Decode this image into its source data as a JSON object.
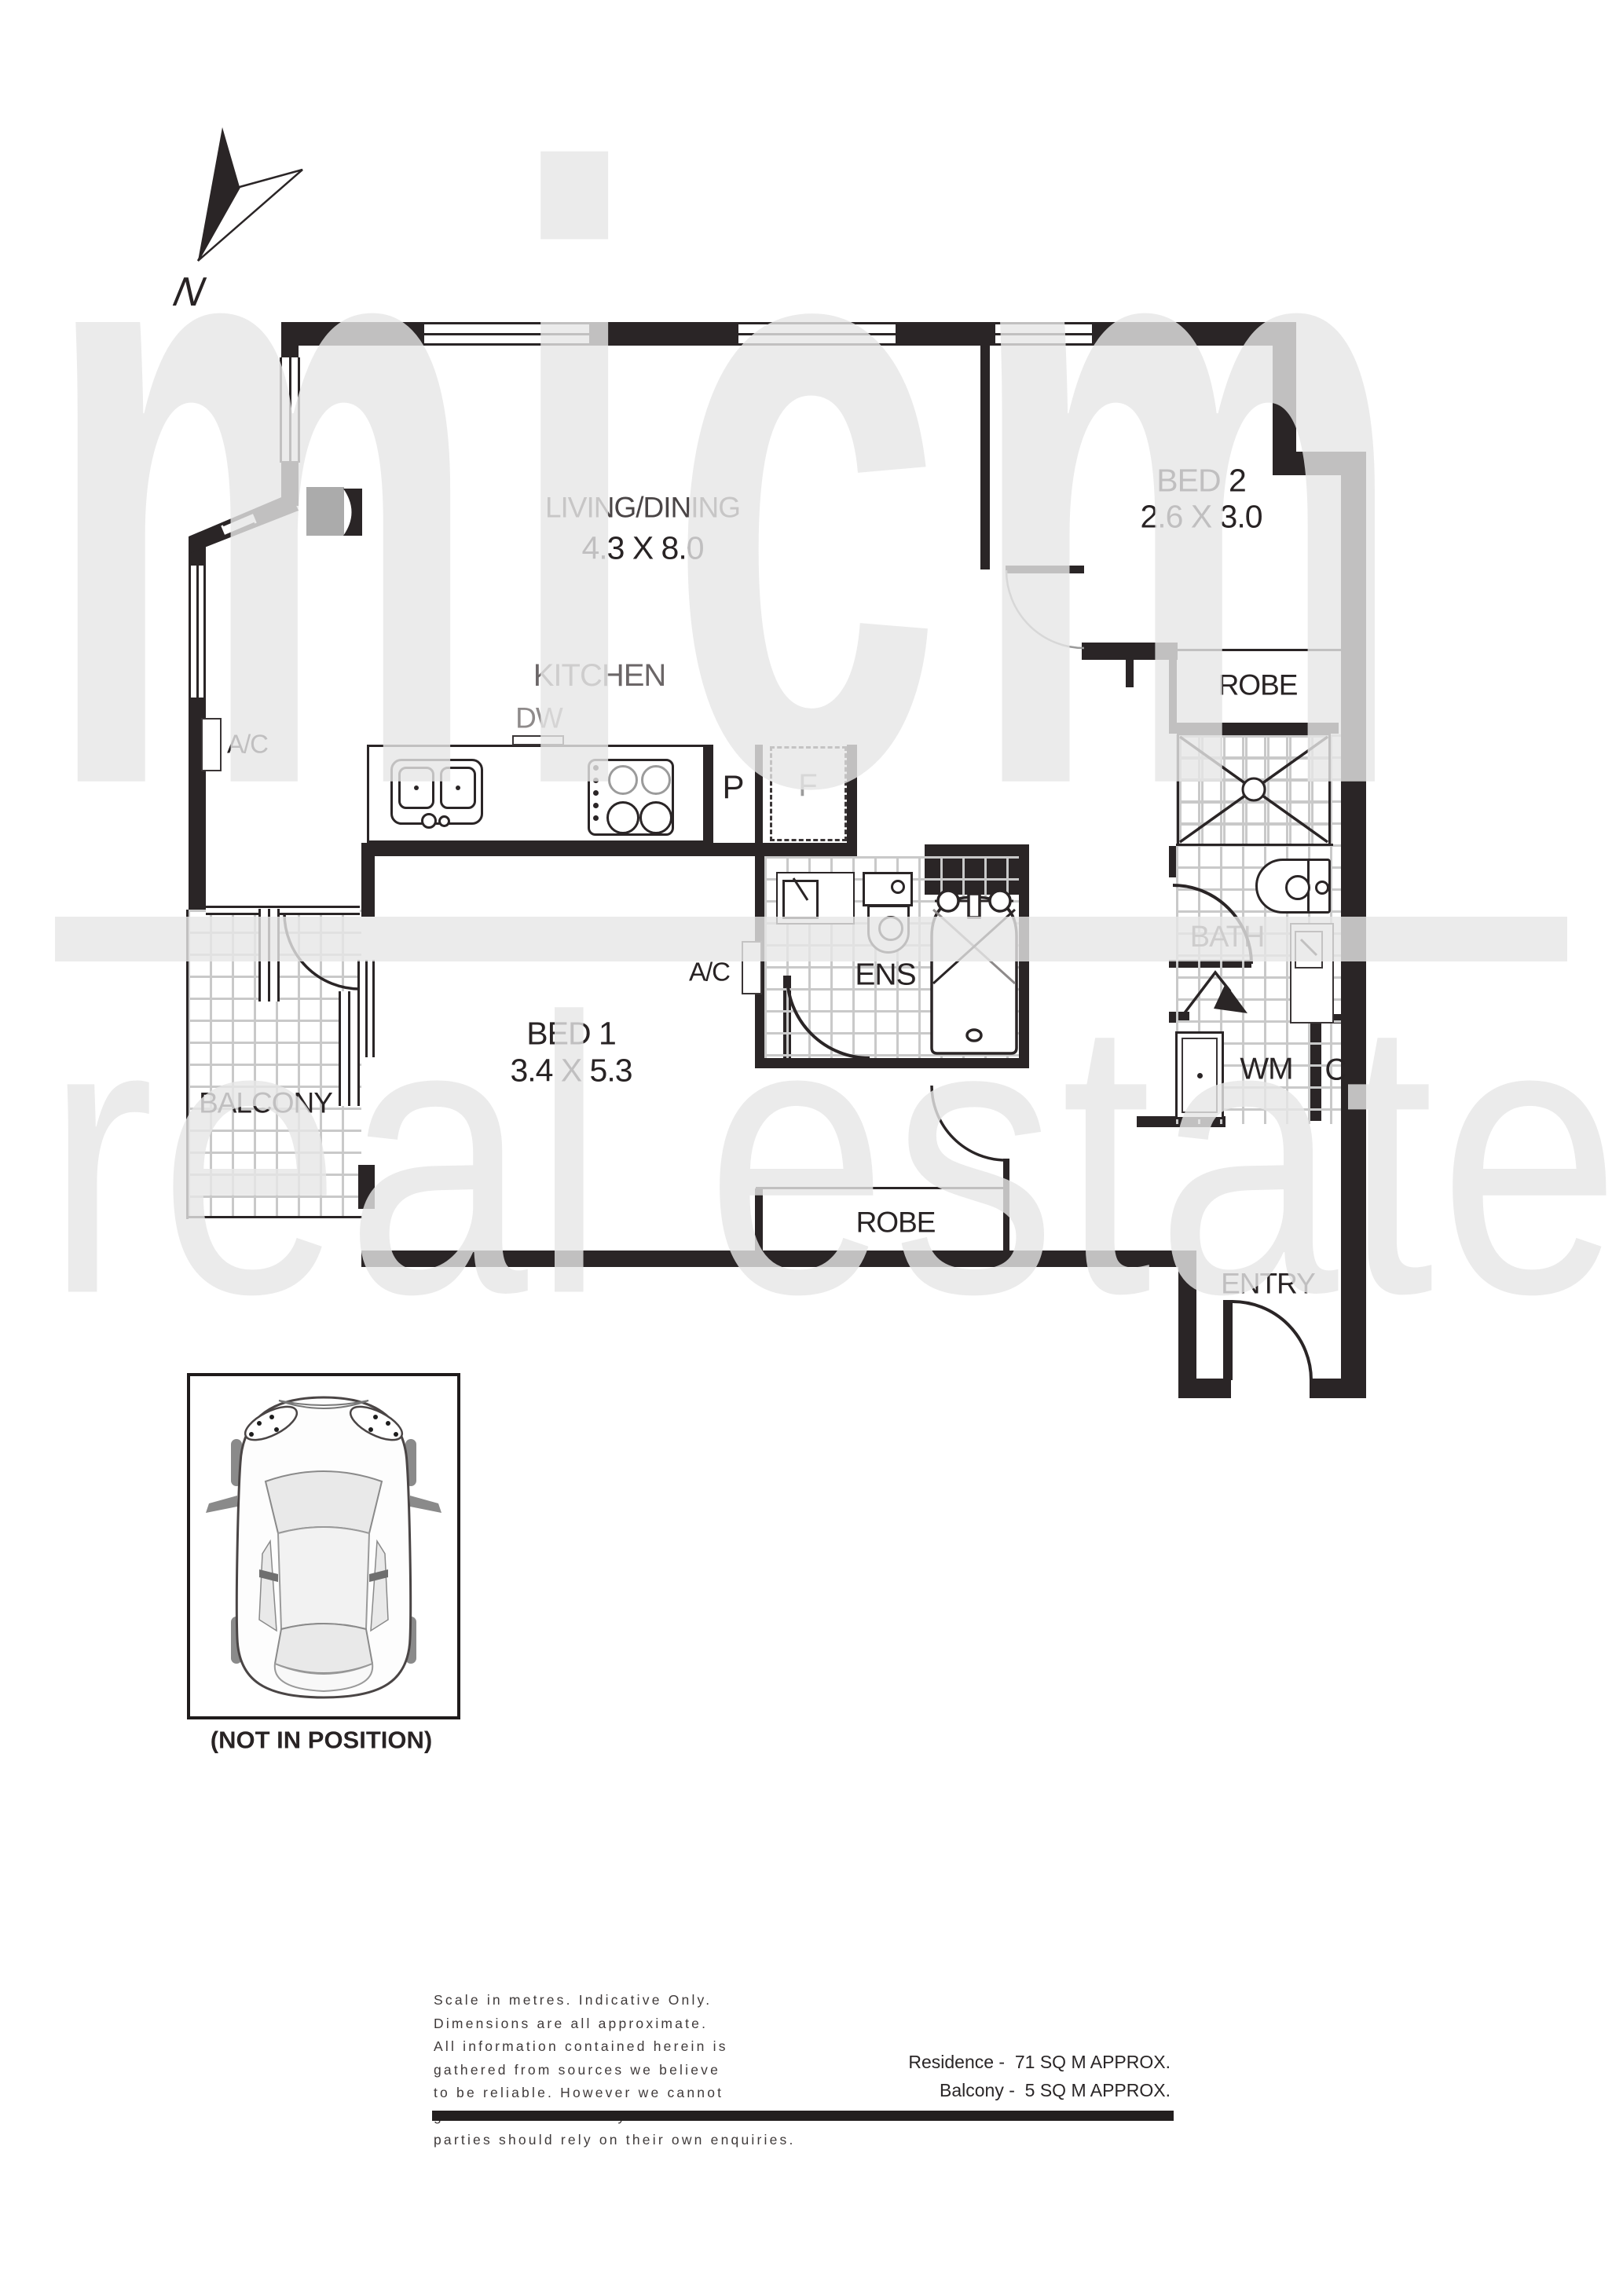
{
  "watermark": {
    "word1": "micm",
    "word2": "real estate"
  },
  "compass": {
    "label": "N"
  },
  "plan": {
    "living": {
      "name": "LIVING/DINING",
      "dims": "4.3 X 8.0"
    },
    "kitchen": {
      "name": "KITCHEN",
      "dw": "DW",
      "pantry": "P",
      "fridge": "F"
    },
    "bed1": {
      "name": "BED 1",
      "dims": "3.4 X 5.3"
    },
    "bed2": {
      "name": "BED 2",
      "dims": "2.6 X 3.0"
    },
    "ens": {
      "name": "ENS",
      "ac": "A/C"
    },
    "ac_left": "A/C",
    "bath": {
      "name": "BATH"
    },
    "robe_top": "ROBE",
    "robe_bottom": "ROBE",
    "laundry": {
      "wm": "WM",
      "cupboard": "C"
    },
    "entry": "ENTRY",
    "balcony": "BALCONY"
  },
  "carpark": {
    "caption": "(NOT IN POSITION)"
  },
  "footer": {
    "disclaimer_lines": [
      "Scale in metres. Indicative Only.",
      "Dimensions are all approximate.",
      "All information contained herein is",
      "gathered from sources we believe",
      "to be reliable. However we cannot",
      "guarantee its accuracy and interested",
      "parties should rely on their own enquiries."
    ],
    "residence_area": "Residence -  71 SQ M APPROX.",
    "balcony_area": "Balcony -  5 SQ M APPROX."
  }
}
